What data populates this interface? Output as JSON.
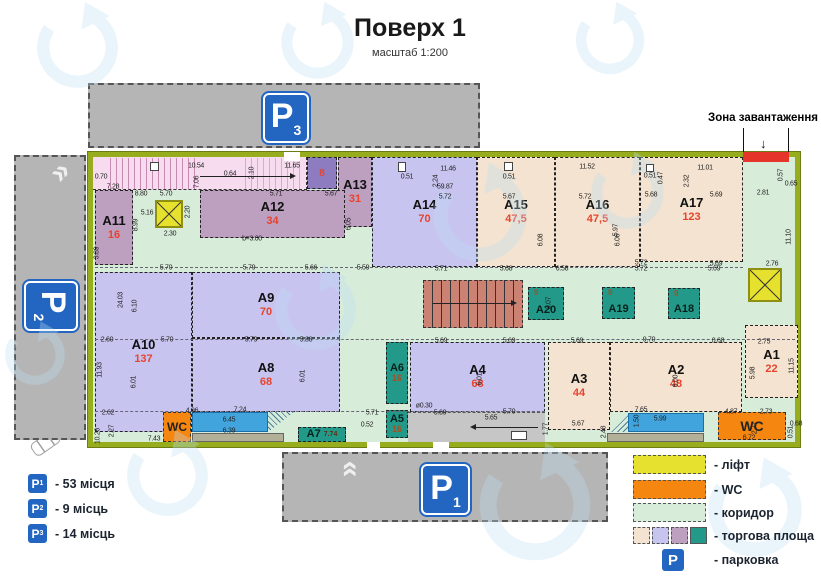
{
  "header": {
    "title": "Поверх 1",
    "scale": "масштаб 1:200"
  },
  "loading_zone": {
    "label": "Зона завантаження",
    "arrow": "↓"
  },
  "wc_label": "WC",
  "units": [
    {
      "id": "A1",
      "area": "22"
    },
    {
      "id": "A2",
      "area": "48"
    },
    {
      "id": "A3",
      "area": "44"
    },
    {
      "id": "A4",
      "area": "68"
    },
    {
      "id": "A5",
      "area": "16"
    },
    {
      "id": "A6",
      "area": "16"
    },
    {
      "id": "A7",
      "area": "",
      "dim": "7.74"
    },
    {
      "id": "A8",
      "area": "68"
    },
    {
      "id": "A9",
      "area": "70"
    },
    {
      "id": "A10",
      "area": "137"
    },
    {
      "id": "A11",
      "area": "16"
    },
    {
      "id": "A12",
      "area": "34"
    },
    {
      "id": "A13",
      "area": "31"
    },
    {
      "id": "A14",
      "area": "70"
    },
    {
      "id": "A15",
      "area": "47,5"
    },
    {
      "id": "A16",
      "area": "47,5"
    },
    {
      "id": "A17",
      "area": "123"
    },
    {
      "id": "A18",
      "area": "9"
    },
    {
      "id": "A19",
      "area": "9"
    },
    {
      "id": "A20",
      "area": "9"
    }
  ],
  "small_unit": {
    "area": "8"
  },
  "signs": {
    "p1": {
      "letter": "P",
      "num": "1"
    },
    "p2": {
      "letter": "P",
      "num": "2"
    },
    "p3": {
      "letter": "P",
      "num": "3"
    },
    "legend": {
      "letter": "P"
    }
  },
  "legend_parking": [
    {
      "num": "1",
      "label": "- 53 місця"
    },
    {
      "num": "2",
      "label": "- 9 місць"
    },
    {
      "num": "3",
      "label": "- 14 місць"
    }
  ],
  "legend_map": [
    {
      "key": "lift",
      "label": "- ліфт"
    },
    {
      "key": "wc",
      "label": "- WC"
    },
    {
      "key": "corridor",
      "label": "- коридор"
    },
    {
      "key": "retail",
      "label": "- торгова площа"
    },
    {
      "key": "parking",
      "label": "- парковка"
    }
  ],
  "colors": {
    "wall": "#97ad1e",
    "corridor": "#d8ecda",
    "retail_beige": "#f4e3d0",
    "retail_lavender": "#c8c4f0",
    "retail_mauve": "#bd9fc0",
    "retail_teal": "#23998a",
    "lift": "#e6e02e",
    "wc": "#f5860f",
    "parking_sign": "#2366c2",
    "stairs": "#cb8272",
    "pink_corridor": "#f7dcef",
    "ramp_blue": "#41a4dd",
    "loading_red": "#e5352b",
    "parking_lot": "#b5b5b5",
    "area_number": "#e8432c"
  },
  "dimensions": [
    [
      "0.70",
      101,
      177,
      0
    ],
    [
      "7.28",
      113,
      187,
      0
    ],
    [
      "10.54",
      196,
      166,
      0
    ],
    [
      "0.64",
      230,
      174,
      0
    ],
    [
      "2.10",
      252,
      173,
      1
    ],
    [
      "7.06",
      197,
      182,
      1
    ],
    [
      "11.65",
      292,
      166,
      0
    ],
    [
      "8.80",
      141,
      194,
      0
    ],
    [
      "5.70",
      166,
      194,
      0
    ],
    [
      "5.71",
      276,
      194,
      0
    ],
    [
      "5.67",
      331,
      194,
      0
    ],
    [
      "5.16",
      147,
      213,
      0
    ],
    [
      "2.20",
      188,
      212,
      1
    ],
    [
      "2.30",
      170,
      234,
      0
    ],
    [
      "8.99",
      136,
      225,
      1
    ],
    [
      "3.89",
      97,
      253,
      1
    ],
    [
      "b=3.00",
      252,
      239,
      0
    ],
    [
      "6.05",
      349,
      224,
      1
    ],
    [
      "11.46",
      448,
      169,
      0
    ],
    [
      "0.51",
      407,
      177,
      0
    ],
    [
      "2.24",
      436,
      181,
      1
    ],
    [
      "59.87",
      445,
      187,
      0
    ],
    [
      "5.72",
      445,
      197,
      0
    ],
    [
      "0.51",
      509,
      177,
      0
    ],
    [
      "11.52",
      587,
      167,
      0
    ],
    [
      "5.67",
      509,
      197,
      0
    ],
    [
      "5.72",
      585,
      197,
      0
    ],
    [
      "0.51",
      650,
      176,
      0
    ],
    [
      "0.47",
      661,
      178,
      1
    ],
    [
      "11.01",
      705,
      168,
      0
    ],
    [
      "2.32",
      687,
      181,
      1
    ],
    [
      "5.68",
      651,
      195,
      0
    ],
    [
      "5.69",
      716,
      195,
      0
    ],
    [
      "2.81",
      763,
      193,
      0
    ],
    [
      "0.57",
      781,
      175,
      1
    ],
    [
      "0.65",
      791,
      184,
      0
    ],
    [
      "6.08",
      541,
      240,
      1
    ],
    [
      "6.06",
      618,
      240,
      1
    ],
    [
      "5.97",
      616,
      230,
      1
    ],
    [
      "11.10",
      789,
      237,
      1
    ],
    [
      "24.03",
      121,
      300,
      1
    ],
    [
      "6.10",
      135,
      306,
      1
    ],
    [
      "11.93",
      100,
      370,
      1
    ],
    [
      "6.01",
      134,
      382,
      1
    ],
    [
      "6.01",
      303,
      376,
      1
    ],
    [
      "6.01",
      480,
      379,
      1
    ],
    [
      "6.00",
      676,
      381,
      1
    ],
    [
      "5.98",
      753,
      373,
      1
    ],
    [
      "11.15",
      792,
      366,
      1
    ],
    [
      "3.07",
      549,
      303,
      1
    ],
    [
      "5.70",
      166,
      268,
      0
    ],
    [
      "5.79",
      249,
      268,
      0
    ],
    [
      "5.66",
      311,
      268,
      0
    ],
    [
      "5.59",
      363,
      268,
      0
    ],
    [
      "5.71",
      441,
      269,
      0
    ],
    [
      "5.68",
      506,
      269,
      0
    ],
    [
      "6.58",
      562,
      269,
      0
    ],
    [
      "5.72",
      641,
      269,
      0
    ],
    [
      "5.69",
      714,
      269,
      0
    ],
    [
      "5.72",
      641,
      263,
      0
    ],
    [
      "5.69",
      716,
      264,
      0
    ],
    [
      "2.76",
      772,
      264,
      0
    ],
    [
      "2.60",
      107,
      340,
      0
    ],
    [
      "5.70",
      167,
      340,
      0
    ],
    [
      "5.79",
      251,
      340,
      0
    ],
    [
      "5.88",
      306,
      340,
      0
    ],
    [
      "5.69",
      441,
      341,
      0
    ],
    [
      "5.69",
      509,
      341,
      0
    ],
    [
      "5.69",
      577,
      341,
      0
    ],
    [
      "9.70",
      649,
      340,
      0
    ],
    [
      "0.68",
      718,
      341,
      0
    ],
    [
      "2.75",
      764,
      342,
      0
    ],
    [
      "ø0.30",
      424,
      406,
      0
    ],
    [
      "7.24",
      240,
      410,
      0
    ],
    [
      "6.45",
      229,
      420,
      0
    ],
    [
      "6.39",
      229,
      431,
      0
    ],
    [
      "4.96",
      192,
      411,
      0
    ],
    [
      "2.62",
      108,
      413,
      0
    ],
    [
      "7.43",
      154,
      439,
      0
    ],
    [
      "2.27",
      112,
      431,
      1
    ],
    [
      "10.26",
      98,
      436,
      1
    ],
    [
      "5.71",
      372,
      413,
      0
    ],
    [
      "0.52",
      367,
      425,
      0
    ],
    [
      "5.69",
      440,
      413,
      0
    ],
    [
      "5.70",
      509,
      412,
      0
    ],
    [
      "5.65",
      491,
      418,
      0
    ],
    [
      "1.77",
      546,
      429,
      1
    ],
    [
      "5.67",
      578,
      424,
      0
    ],
    [
      "7.65",
      641,
      410,
      0
    ],
    [
      "5.99",
      660,
      419,
      0
    ],
    [
      "1.50",
      637,
      421,
      1
    ],
    [
      "2.48",
      604,
      432,
      1
    ],
    [
      "4.87",
      731,
      412,
      0
    ],
    [
      "2.73",
      766,
      412,
      0
    ],
    [
      "2.77",
      755,
      428,
      1
    ],
    [
      "6.72",
      749,
      438,
      0
    ],
    [
      "0.51",
      791,
      432,
      1
    ],
    [
      "0.68",
      796,
      424,
      0
    ]
  ]
}
